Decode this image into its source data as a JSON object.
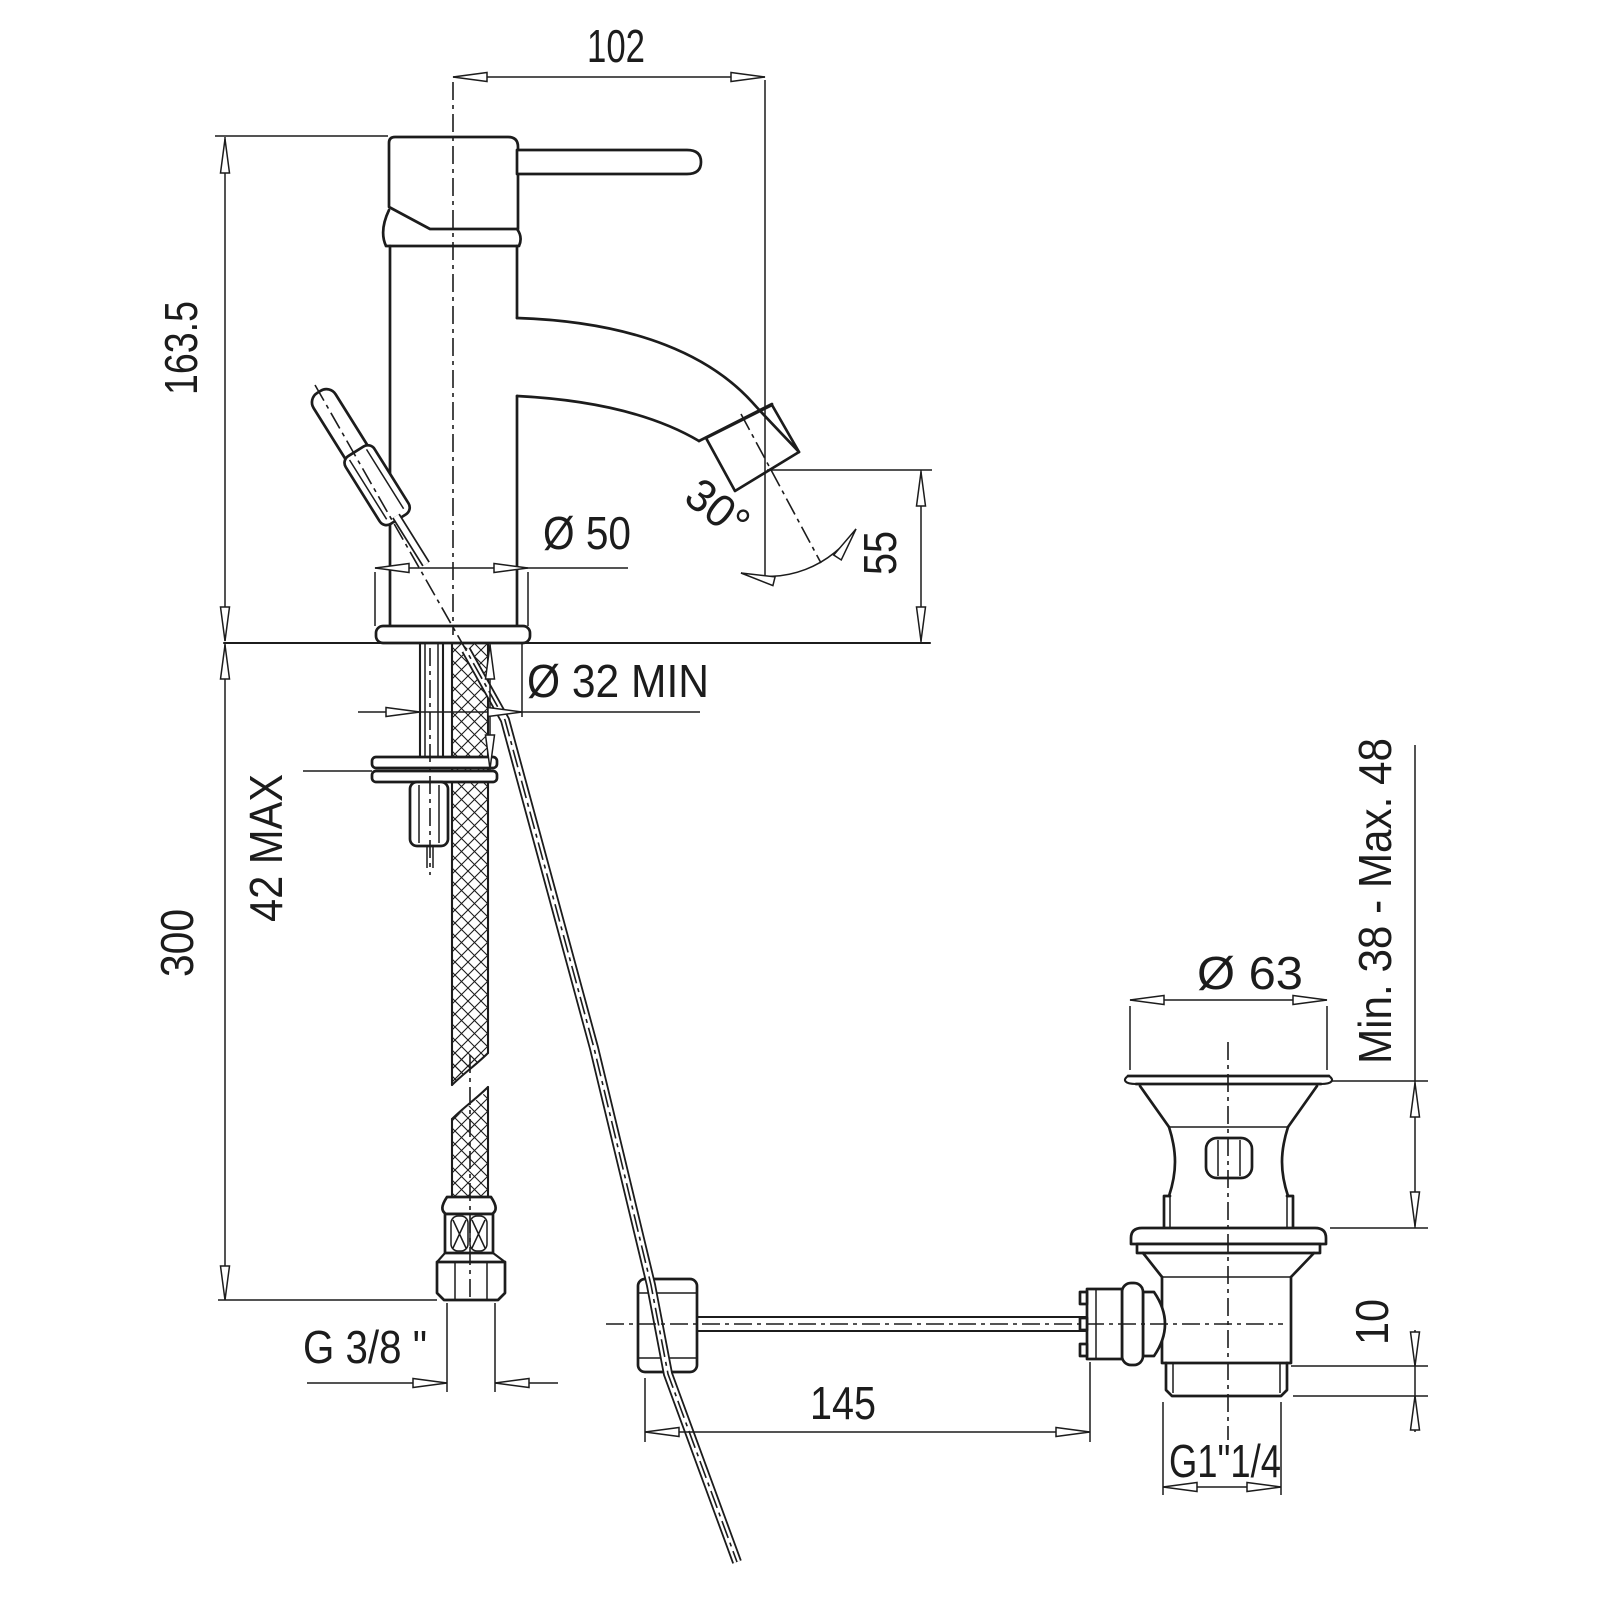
{
  "drawing": {
    "type": "technical-dimension-drawing",
    "subject": "Single-lever basin mixer tap with flexible supply hose and pop-up waste drain",
    "units": "mm",
    "line_color": "#1c1c1c",
    "background_color": "#ffffff",
    "labels": {
      "spout_reach": "102",
      "total_height": "163.5",
      "base_diameter": "Ø 50",
      "spout_swivel_angle": "30°",
      "spout_height": "55",
      "min_hole_diameter": "Ø 32  MIN",
      "max_deck_thickness": "42 MAX",
      "hose_drop": "300",
      "supply_thread": "G  3/8 \"",
      "linkage_reach": "145",
      "waste_top_diameter": "Ø 63",
      "basin_depth_range": "Min. 38  -  Max. 48",
      "collar_height": "10",
      "waste_thread": "G1\"1/4"
    }
  }
}
